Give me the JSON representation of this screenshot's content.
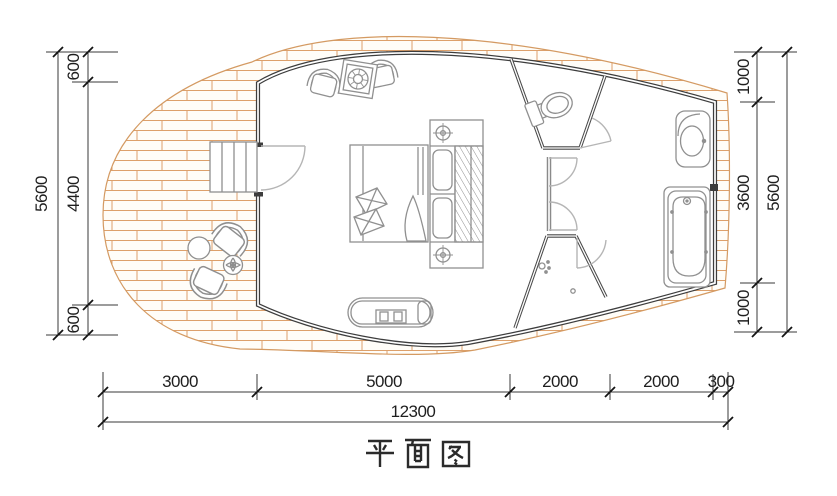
{
  "title": "平面图",
  "colors": {
    "background": "#ffffff",
    "wall": "#3d3d3d",
    "partition": "#4a4a4a",
    "furniture": "#909090",
    "door": "#b8b8b8",
    "brick_line": "#dda06b",
    "dimension": "#1e1e1e"
  },
  "dims": {
    "left_inner": {
      "segments": [
        "600",
        "4400",
        "600"
      ]
    },
    "left_outer": {
      "total": "5600"
    },
    "right_inner": {
      "segments": [
        "1000",
        "3600",
        "1000"
      ]
    },
    "right_outer": {
      "total": "5600"
    },
    "bottom_inner": {
      "segments": [
        "3000",
        "5000",
        "2000",
        "2000",
        "300"
      ]
    },
    "bottom_outer": {
      "total": "12300"
    }
  }
}
